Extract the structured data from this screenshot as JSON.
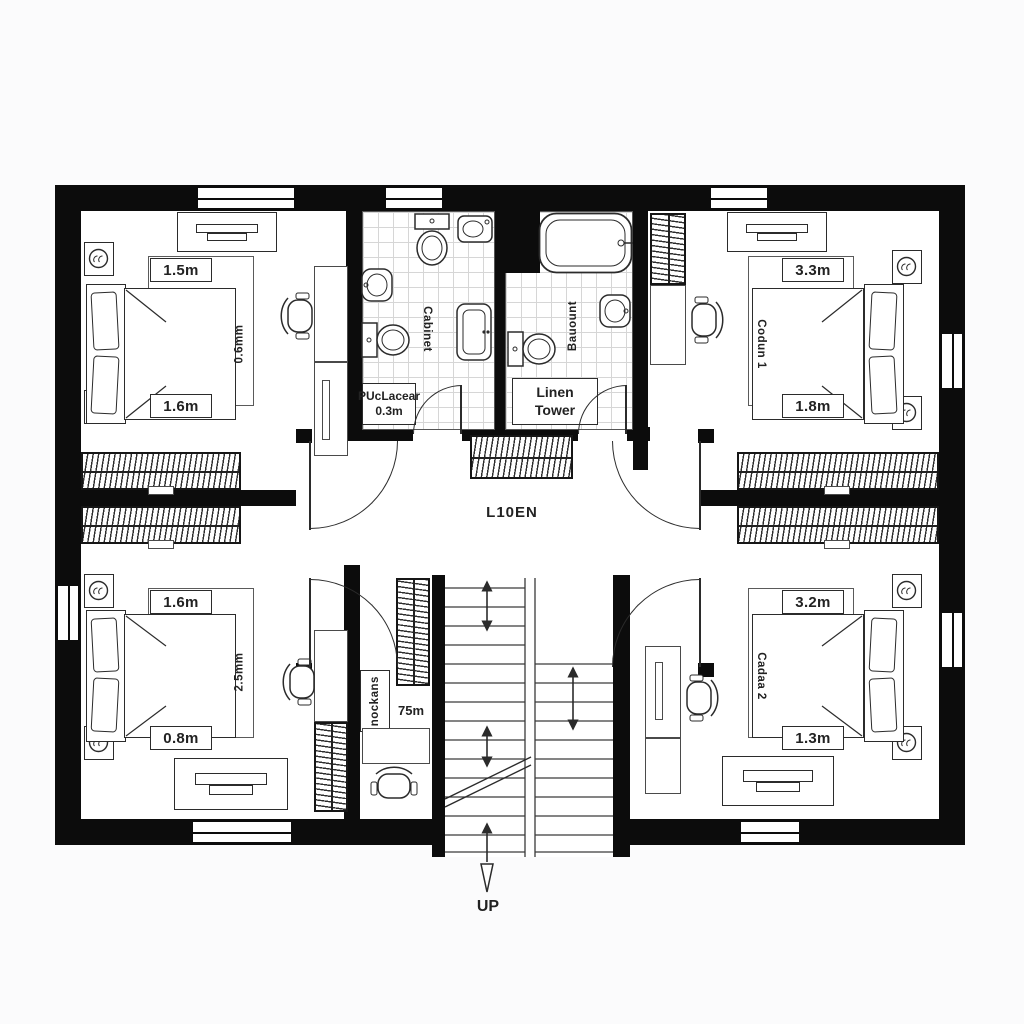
{
  "plan": {
    "hallway": {
      "label": "L10EN"
    },
    "stairs": {
      "direction_label": "UP"
    },
    "bedrooms": {
      "top_left": {
        "width_label": "1.5m",
        "depth_label": "0.6mm",
        "bottom_label": "1.6m"
      },
      "top_right": {
        "width_label": "3.3m",
        "name_label": "Codun 1",
        "bottom_label": "1.8m"
      },
      "bottom_left": {
        "width_label": "1.6m",
        "depth_label": "2.5mm",
        "bottom_label": "0.8m"
      },
      "bottom_right": {
        "width_label": "3.2m",
        "name_label": "Cadaa 2",
        "bottom_label": "1.3m"
      }
    },
    "bathrooms": {
      "left": {
        "vertical_label": "Cabinet",
        "note_line1": "PUcLacear",
        "note_line2": "0.3m"
      },
      "right": {
        "vertical_label": "Bauount",
        "closet_line1": "Linen",
        "closet_line2": "Tower"
      }
    },
    "store_room": {
      "vertical_label": "nockans",
      "area_label": "75m"
    },
    "colors": {
      "wall": "#0c0c0c",
      "line": "#2b2b2b",
      "tile_line": "#d6d6d6",
      "background": "#fbfbfc"
    }
  }
}
